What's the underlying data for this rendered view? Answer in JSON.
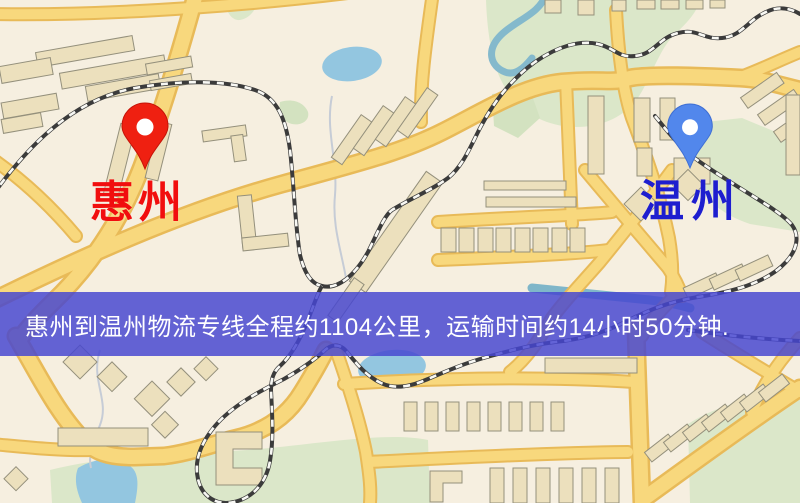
{
  "map": {
    "origin": {
      "label": "惠州",
      "label_color": "#f10e0e",
      "pin_color": "#ef2011"
    },
    "destination": {
      "label": "温州",
      "label_color": "#1e1ecf",
      "pin_color": "#5287ec"
    },
    "banner": {
      "text": "惠州到温州物流专线全程约1104公里，运输时间约14小时50分钟.",
      "background_color": "#4646d0",
      "text_color": "#ffffff"
    },
    "colors": {
      "map_background": "#f6efe0",
      "road_fill": "#f8d87d",
      "road_casing": "#e8ba58",
      "park": "#dbe7c9",
      "water": "#93c6e0",
      "railway": "#3b3b3b",
      "building": "#ece0bd"
    }
  }
}
